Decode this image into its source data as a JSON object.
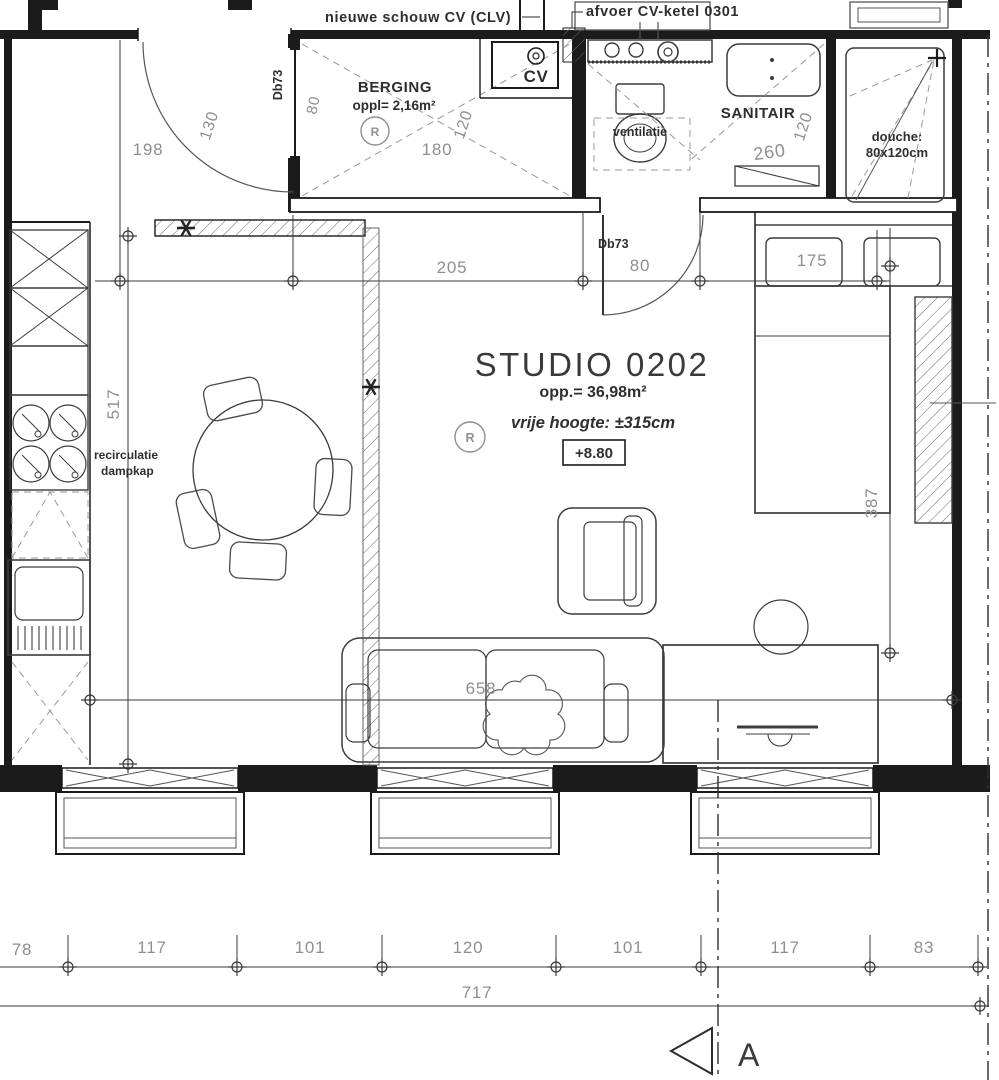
{
  "labels": {
    "chimney_note": "nieuwe schouw CV (CLV)",
    "flue_note": "afvoer CV-ketel  0301"
  },
  "rooms": {
    "berging": {
      "name": "BERGING",
      "area": "oppl= 2,16m²"
    },
    "cv": {
      "name": "CV"
    },
    "sanitair": {
      "name": "SANITAIR",
      "vent": "ventilatie"
    },
    "douche": {
      "line1": "douche:",
      "line2": "80x120cm"
    }
  },
  "studio": {
    "title": "STUDIO 0202",
    "area": "opp.= 36,98m²",
    "height": "vrije hoogte: ±315cm",
    "level": "+8.80"
  },
  "kitchen": {
    "hood1": "recirculatie",
    "hood2": "dampkap"
  },
  "annotations": {
    "door_code": "Db73",
    "detector": "R",
    "section": "A"
  },
  "dims": {
    "top_left": "198",
    "door_radius": "130",
    "berging_door": "80",
    "berging_depth": "120",
    "berging_width": "180",
    "sanitair_width": "260",
    "sanitair_depth": "120",
    "mid_a": "205",
    "mid_b": "80",
    "mid_c": "175",
    "kitchen_len": "517",
    "bed_len": "387",
    "sofa_span": "658",
    "bottom": [
      "78",
      "117",
      "101",
      "120",
      "101",
      "117",
      "83"
    ],
    "total": "717"
  },
  "colors": {
    "ink": "#1b1b1b",
    "furniture": "#3c3c3c",
    "dim_text": "#8f8f8f",
    "background": "#ffffff"
  }
}
